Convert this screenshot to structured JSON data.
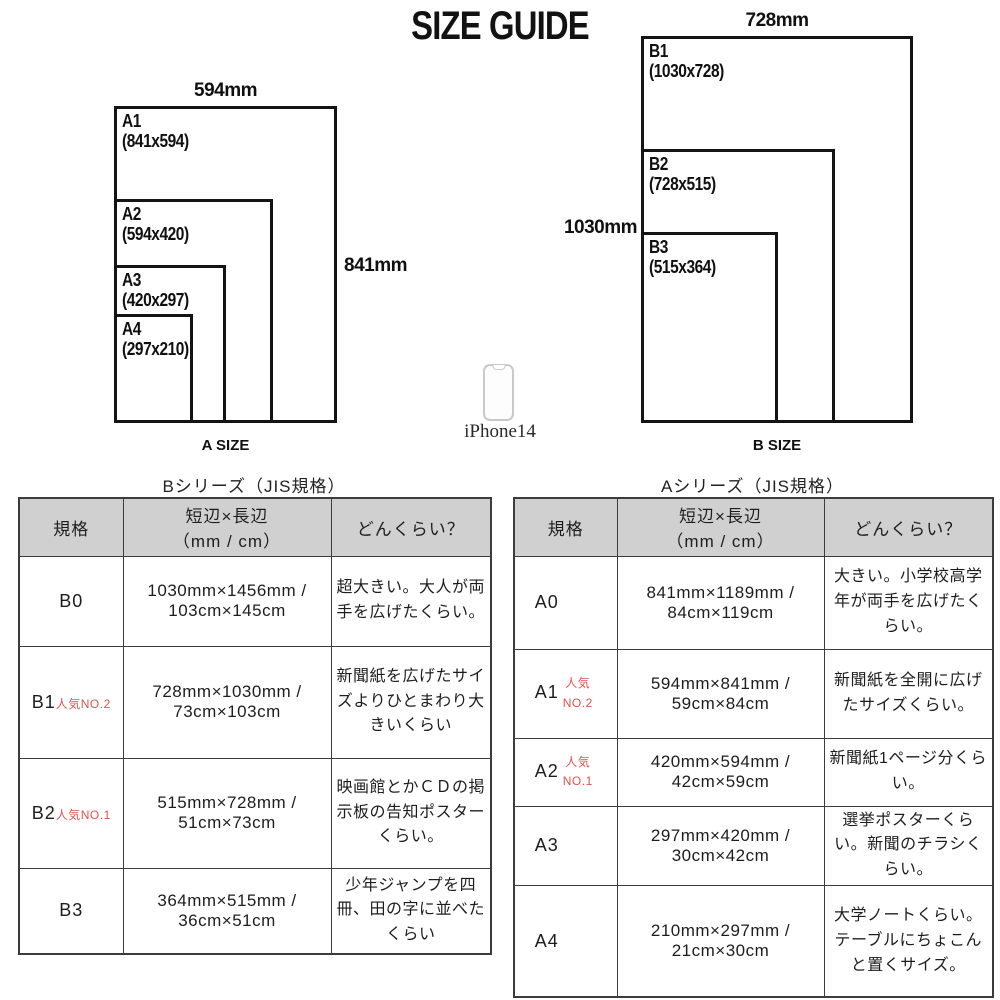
{
  "page": {
    "title": "SIZE GUIDE"
  },
  "diagrams": {
    "a": {
      "caption": "A SIZE",
      "top_dim": "594mm",
      "side_dim": "841mm",
      "sheets": [
        {
          "name": "A1",
          "dims": "(841x594)"
        },
        {
          "name": "A2",
          "dims": "(594x420)"
        },
        {
          "name": "A3",
          "dims": "(420x297)"
        },
        {
          "name": "A4",
          "dims": "(297x210)"
        }
      ]
    },
    "b": {
      "caption": "B SIZE",
      "top_dim": "728mm",
      "side_dim": "1030mm",
      "sheets": [
        {
          "name": "B1",
          "dims": "(1030x728)"
        },
        {
          "name": "B2",
          "dims": "(728x515)"
        },
        {
          "name": "B3",
          "dims": "(515x364)"
        }
      ]
    },
    "phone": {
      "label": "iPhone14"
    }
  },
  "tables": {
    "b_series": {
      "title": "Bシリーズ（JIS規格）",
      "headers": {
        "col1": "規格",
        "col2_line1": "短辺×長辺",
        "col2_line2": "（mm / cm）",
        "col3": "どんくらい？"
      },
      "rows": [
        {
          "code": "B0",
          "badge": "",
          "size": "1030mm×1456mm / 103cm×145cm",
          "desc": "超大きい。大人が両手を広げたくらい。"
        },
        {
          "code": "B1",
          "badge": "人気NO.2",
          "size": "728mm×1030mm / 73cm×103cm",
          "desc": "新聞紙を広げたサイズよりひとまわり大きいくらい"
        },
        {
          "code": "B2",
          "badge": "人気NO.1",
          "size": "515mm×728mm / 51cm×73cm",
          "desc": "映画館とかＣＤの掲示板の告知ポスターくらい。"
        },
        {
          "code": "B3",
          "badge": "",
          "size": "364mm×515mm / 36cm×51cm",
          "desc": "少年ジャンプを四冊、田の字に並べたくらい"
        }
      ]
    },
    "a_series": {
      "title": "Aシリーズ（JIS規格）",
      "headers": {
        "col1": "規格",
        "col2_line1": "短辺×長辺",
        "col2_line2": "（mm / cm）",
        "col3": "どんくらい？"
      },
      "rows": [
        {
          "code": "A0",
          "badge": "",
          "size": "841mm×1189mm / 84cm×119cm",
          "desc": "大きい。小学校高学年が両手を広げたくらい。"
        },
        {
          "code": "A1",
          "badge": "人気NO.2",
          "size": "594mm×841mm / 59cm×84cm",
          "desc": "新聞紙を全開に広げたサイズくらい。"
        },
        {
          "code": "A2",
          "badge": "人気NO.1",
          "size": "420mm×594mm / 42cm×59cm",
          "desc": "新聞紙1ページ分くらい。"
        },
        {
          "code": "A3",
          "badge": "",
          "size": "297mm×420mm / 30cm×42cm",
          "desc": "選挙ポスターくらい。新聞のチラシくらい。"
        },
        {
          "code": "A4",
          "badge": "",
          "size": "210mm×297mm / 21cm×30cm",
          "desc": "大学ノートくらい。テーブルにちょこんと置くサイズ。"
        }
      ]
    }
  },
  "colors": {
    "accent_red": "#dd544e",
    "header_bg": "#d0d0d0",
    "border": "#3c3c3c",
    "line": "#141414"
  }
}
